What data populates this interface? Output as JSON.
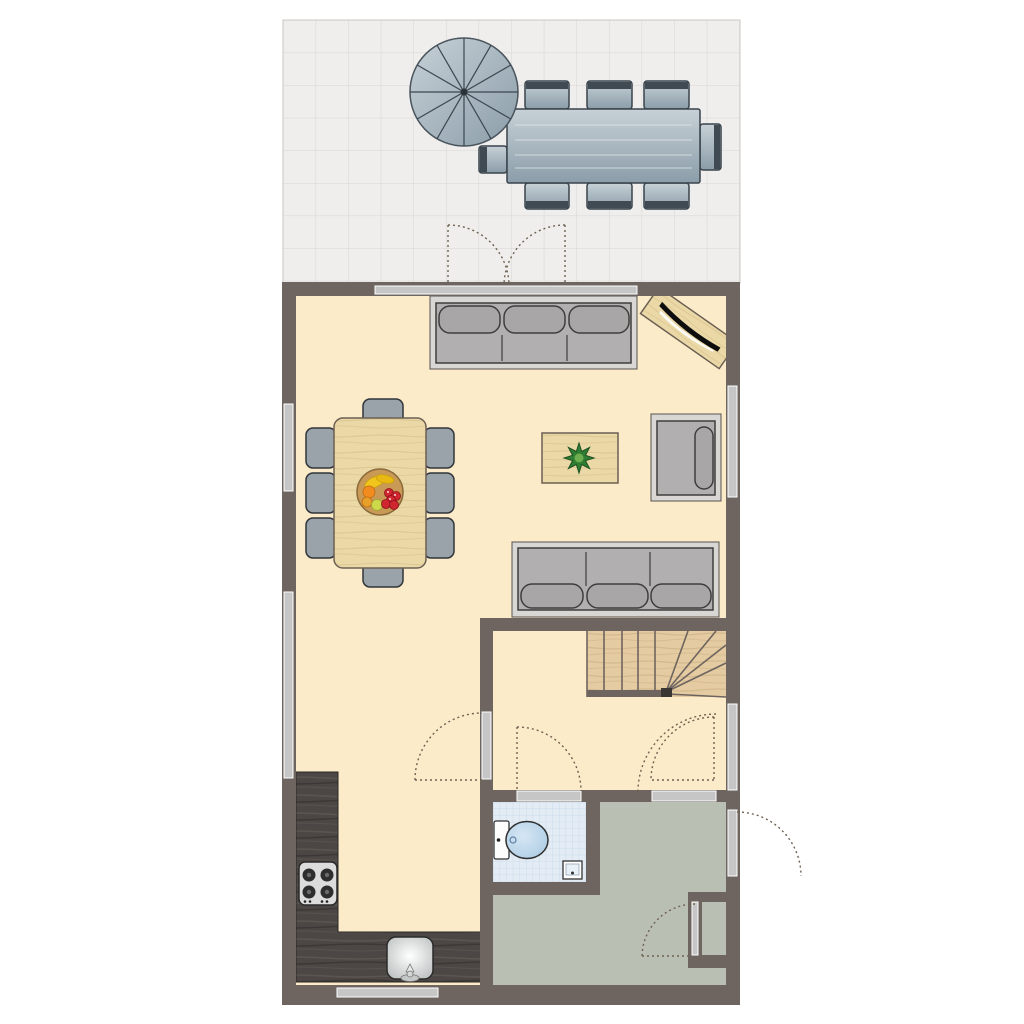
{
  "colors": {
    "wall": "#6e6560",
    "floor_cream": "#fcebc8",
    "floor_hall": "#b9bfb3",
    "bath_tile": "#e3ecf5",
    "bath_grid": "#cbdbeb",
    "terrace_tile": "#efeeed",
    "terrace_grid": "#d8d6d3",
    "window_bar": "#c6c6c6",
    "wood_light": "#ead8a7",
    "wood_grain": "#d9c28c",
    "stairs_wood": "#e5cba1",
    "stairs_grain": "#d2b78c",
    "counter_dark": "#4c4744",
    "counter_grain": "#5d5751",
    "sofa_outer": "#d8d7d3",
    "sofa_body": "#b2afb0",
    "sofa_cushion": "#a9a6a7",
    "outline_dark": "#3e3e3c",
    "chair_gray": "#9aa2aa",
    "chair_dark": "#2f353b",
    "metal_light": "#c7d1d7",
    "metal_dark": "#8b9da9",
    "band_dark": "#3f4a52",
    "arc": "#6f6252",
    "plant_dark": "#2f7d33",
    "plant_light": "#6fae4e",
    "fruit_red": "#cf2630",
    "fruit_orange": "#f28c1e",
    "fruit_yellow": "#f2c51d",
    "bowl_tan": "#c99a55",
    "hob_face": "#dcdcdc",
    "burner": "#2e2e2e",
    "porcelain": "#fdfdfd",
    "toilet_blue_light": "#d6e7f4",
    "toilet_blue": "#a9c9e2",
    "sink_hi": "#ffffff",
    "sink_lo": "#b4b8b8"
  },
  "items": [
    "terrace-tiled-patio",
    "parasol",
    "outdoor-dining-table",
    "outdoor-chairs-8",
    "terrace-double-door",
    "sliding-glass-door",
    "living-room-floor",
    "sofa-three-seat-top",
    "wall-board-with-tv",
    "dining-table-wood",
    "dining-chairs-8",
    "fruit-bowl",
    "coffee-table",
    "potted-plant",
    "armchair",
    "sofa-three-seat-lower",
    "staircase-with-winders",
    "interior-door-living-hall",
    "interior-door-bathroom",
    "interior-door-entrance",
    "front-door",
    "storage-closet-door",
    "kitchen-counter-L",
    "cooktop-4-burner",
    "kitchen-sink",
    "toilet",
    "bathroom-washbasin",
    "windows-5",
    "entrance-hall-floor",
    "bathroom-tile-floor"
  ]
}
